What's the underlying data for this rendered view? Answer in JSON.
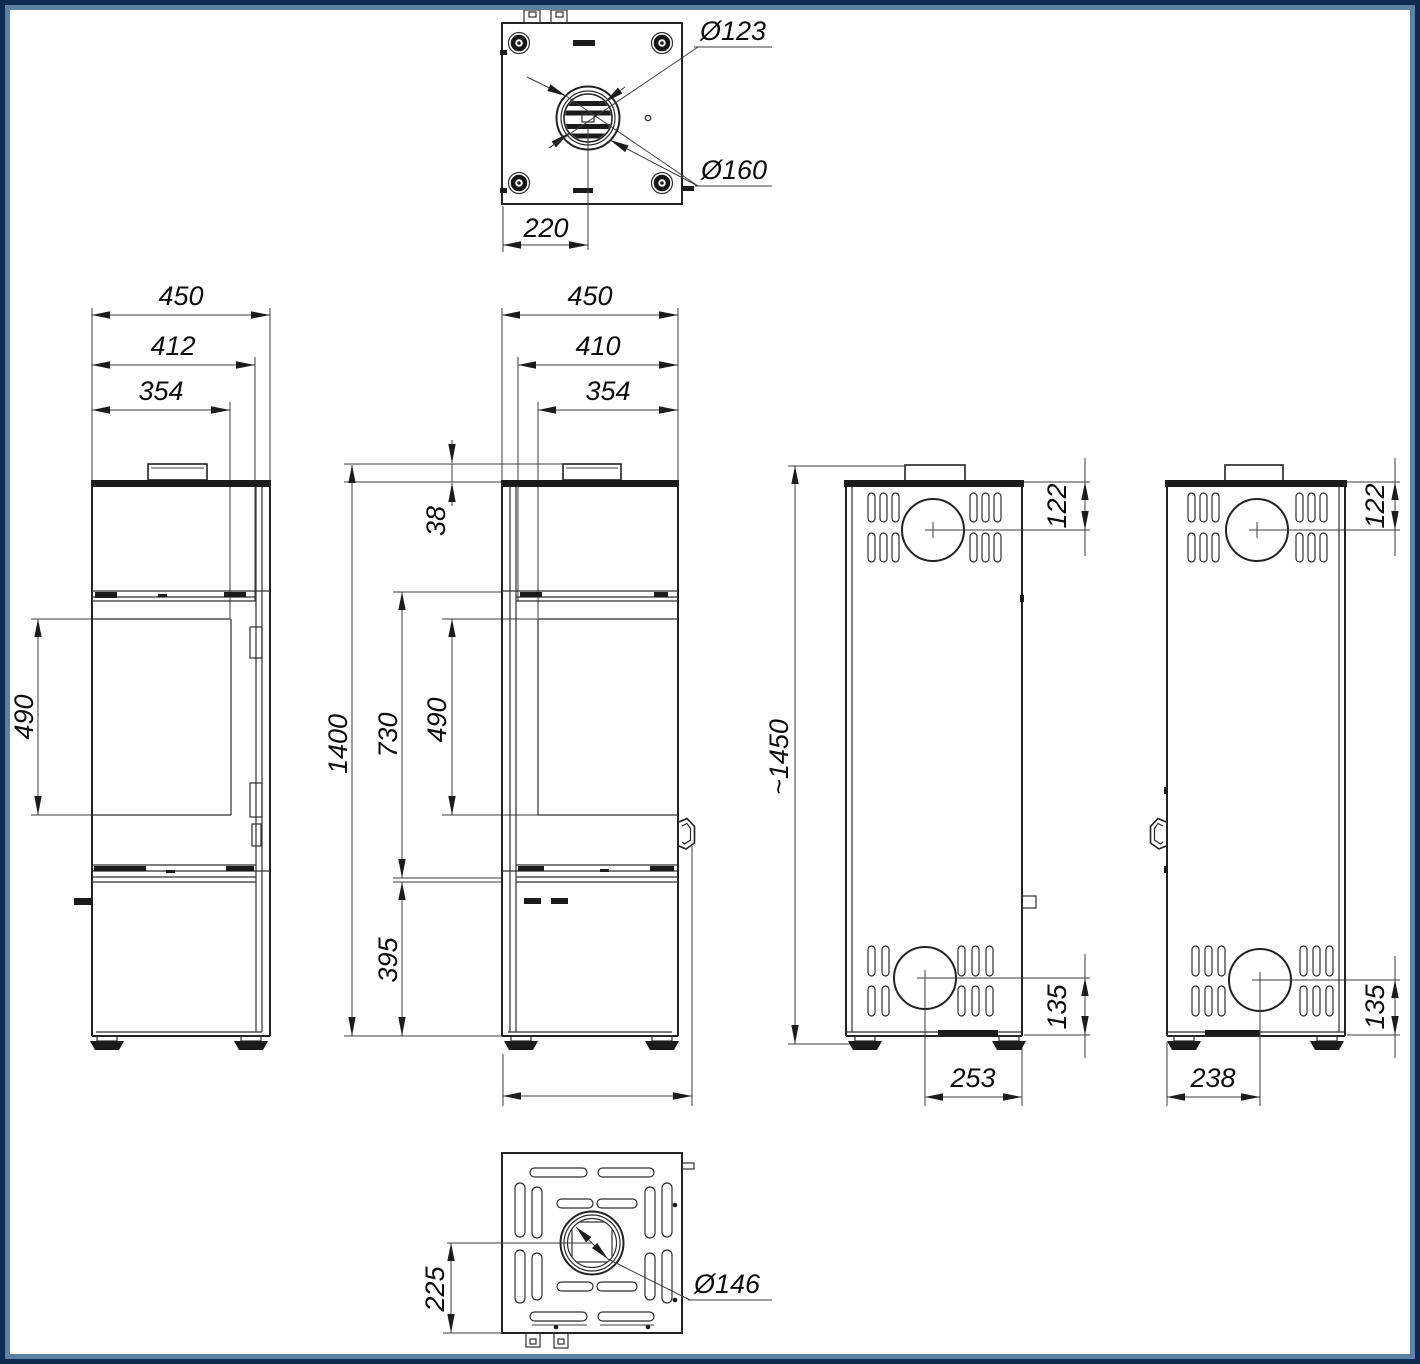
{
  "views": {
    "top": {
      "dia_inner": "Ø123",
      "dia_outer": "Ø160",
      "offset": "220"
    },
    "front": {
      "width": "450",
      "door_width": "412",
      "glass_width": "354",
      "glass_height": "490"
    },
    "side": {
      "width": "450",
      "door_width": "410",
      "glass_width": "354",
      "collar_height": "38",
      "total_height": "1400",
      "upper_height": "730",
      "glass_height": "490",
      "base_height": "395"
    },
    "rear_left": {
      "total_height": "~1450",
      "top_offset": "122",
      "bottom_offset": "135",
      "bottom_distance": "253"
    },
    "rear_right": {
      "top_offset": "122",
      "bottom_offset": "135",
      "bottom_distance": "238"
    },
    "bottom": {
      "offset": "225",
      "dia": "Ø146"
    }
  },
  "colors": {
    "line": "#222222",
    "border_outer": "#0d2a52",
    "border_inner": "#5d81a2",
    "background": "#ffffff"
  }
}
